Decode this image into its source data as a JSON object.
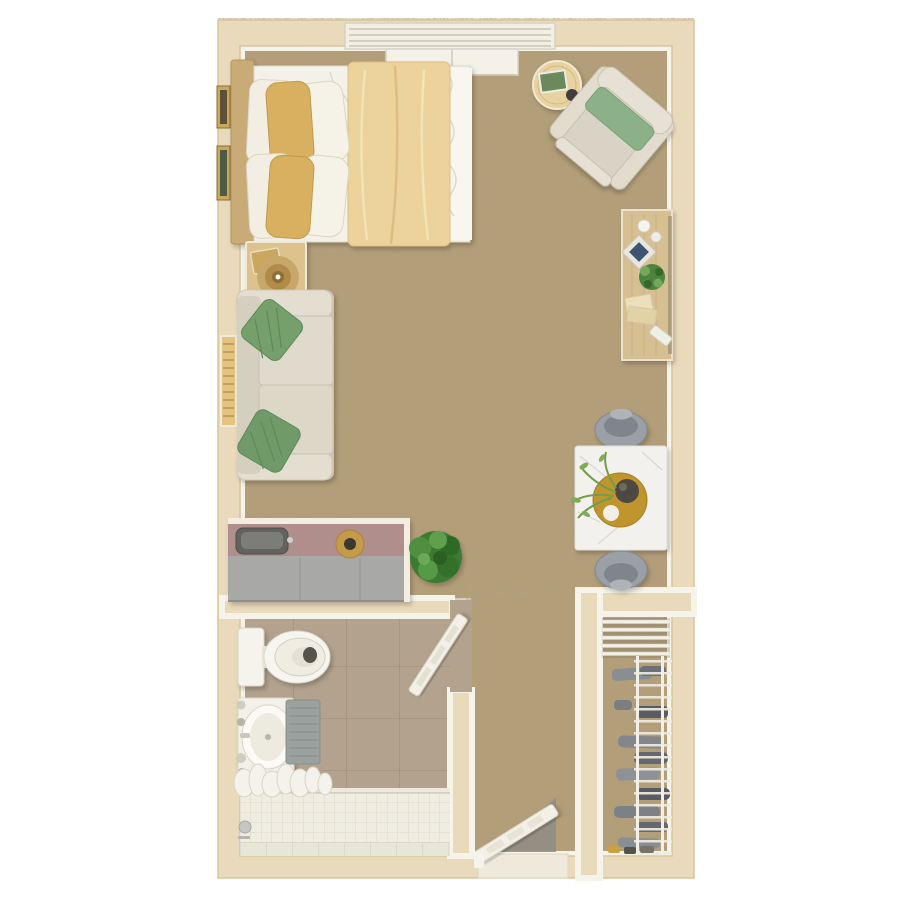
{
  "plan": {
    "kind": "studio-apartment-floor-plan",
    "view": "top-down-3d-render",
    "rooms": [
      {
        "id": "main-room",
        "floor": "carpet",
        "furniture": [
          "bed",
          "headboard",
          "wall-art",
          "nightstand",
          "table-lamp",
          "sofa",
          "throw-pillows",
          "round-side-table",
          "armchair",
          "desk",
          "desk-chair",
          "dining-table",
          "dining-chairs",
          "kitchenette-counter",
          "sink",
          "fruit-bowl",
          "potted-bush",
          "window-bench"
        ]
      },
      {
        "id": "bathroom",
        "floor": "tile",
        "furniture": [
          "toilet",
          "vanity-sink",
          "bath-mat",
          "shower",
          "shower-curtain",
          "shower-valve",
          "bathroom-door"
        ]
      },
      {
        "id": "closet",
        "floor": "carpet",
        "furniture": [
          "wire-shelf-top-unit",
          "wire-shelf-side-unit",
          "folded-clothes",
          "shoes"
        ]
      },
      {
        "id": "hallway",
        "floor": "carpet",
        "furniture": [
          "entry-door",
          "door-mat",
          "threshold"
        ]
      }
    ],
    "windows": [
      {
        "id": "top-window",
        "style": "horizontal-blinds"
      },
      {
        "id": "left-window",
        "style": "wood-blinds"
      }
    ]
  },
  "palette": {
    "wall": "#e9dabb",
    "wall_trim": "#f6f3ea",
    "wall_edge": "#d8c49e",
    "carpet": "#b49c74",
    "bathroom_tile": "#b2a28e",
    "shower_wall_tile": "#efede1",
    "shower_floor_tile": "#e8e6d9",
    "counter_top": "#b08e8b",
    "counter_front": "#a8a8a6",
    "sink_dark": "#62625f",
    "bed_sheet": "#f4f1e8",
    "bed_duvet": "#ecd39c",
    "pillow_gold": "#d9b05e",
    "pillow_white": "#f2eee3",
    "headboard_wood": "#c8ab77",
    "nightstand_wood": "#ddc28e",
    "desk_wood": "#d6bf92",
    "side_table_wood": "#e8d2a2",
    "sofa": "#dfdacb",
    "sofa_arm": "#e3decf",
    "pillow_green": "#74a06c",
    "armchair": "#d8d3c4",
    "armchair_pillow": "#8cb189",
    "marble": "#f2f1ee",
    "dining_chair_gray": "#9aa0a5",
    "tray_gold": "#c0952e",
    "vase_dark": "#4d4a43",
    "plant_green": "#4e8340",
    "bush_green": "#3c7a31",
    "fixture_white": "#f5f3ec",
    "mat_gray": "#9ba19f",
    "curtain_white": "#f4f2ea",
    "closet_shelf_white": "#f2efe6",
    "clothes_gray": "#6d7176",
    "door_white": "#f3f0e7",
    "blinds_white": "#f2efe5",
    "blinds_gold": "#e3c37f"
  }
}
